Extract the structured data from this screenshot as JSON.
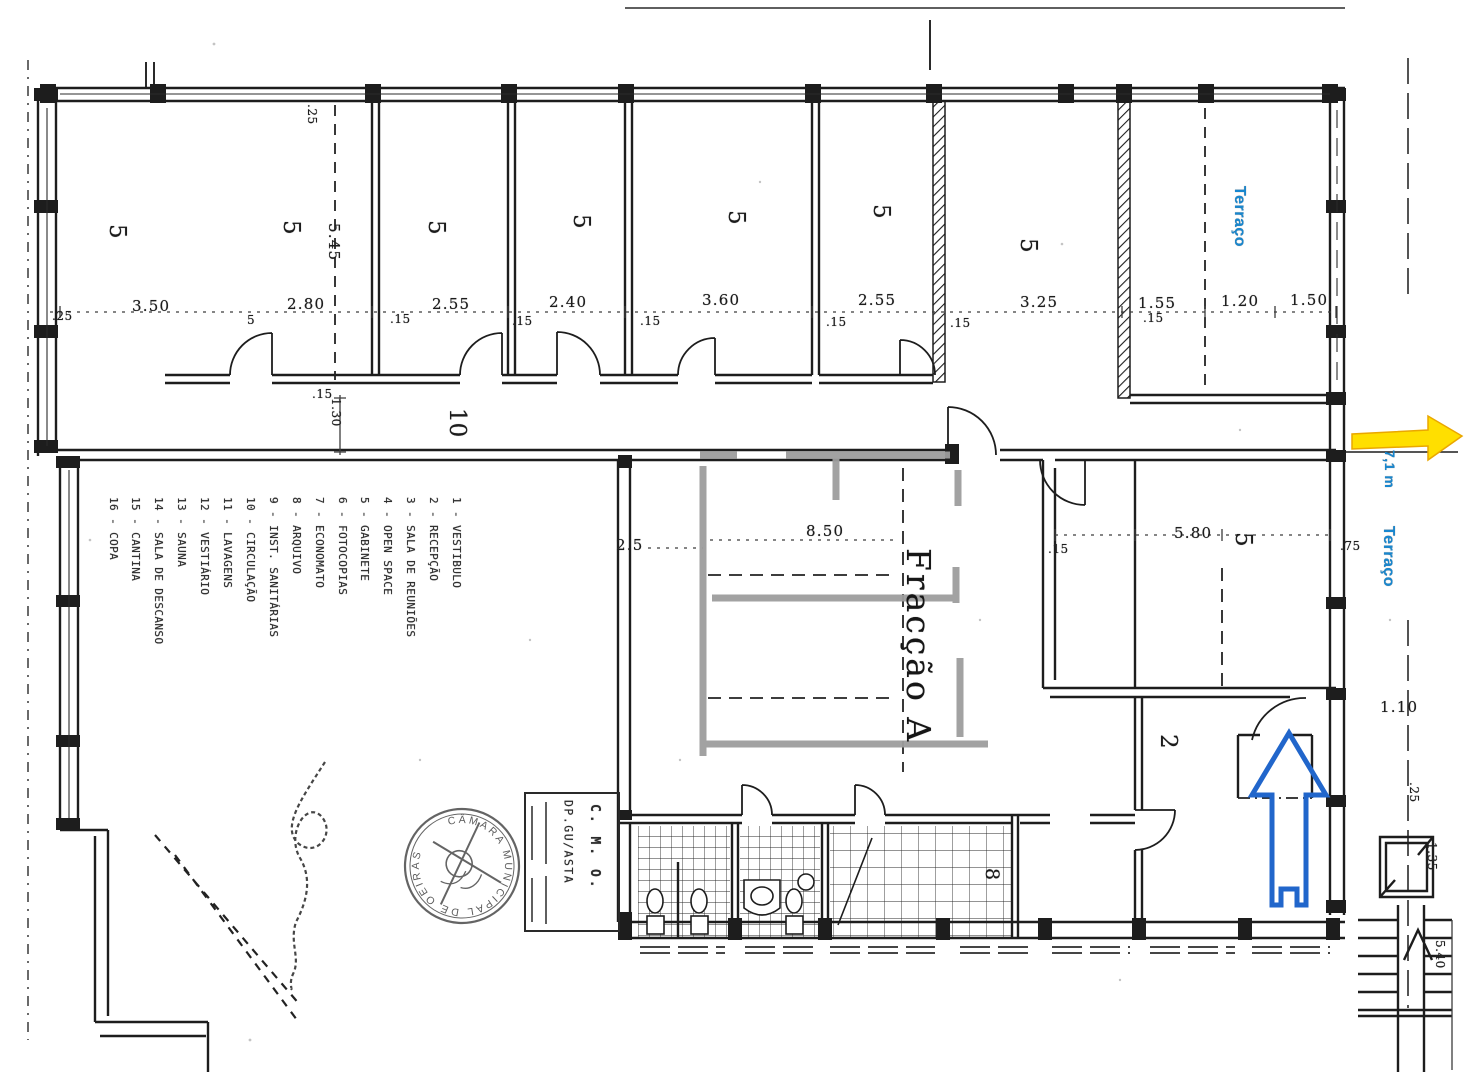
{
  "colors": {
    "ink": "#1d1d1d",
    "annotation_blue": "#1887cf",
    "arrow_blue": "#2166cb",
    "arrow_yellow": "#ffdf00",
    "arrow_yellow_stroke": "#eaa700",
    "highlight_gray": "#9d9d9d"
  },
  "fraccao": {
    "label": "Fracção A"
  },
  "stamp": {
    "ring_text": "CÂMARA MUNICIPAL DE OEIRAS"
  },
  "office_box": {
    "line1": "C. M. O.",
    "line2": "DP.GU/ASTA"
  },
  "legend": {
    "x_start": 451,
    "y": 497,
    "spacing": 22.9,
    "items": [
      {
        "num": "1",
        "name": "VESTIBULO"
      },
      {
        "num": "2",
        "name": "RECEPÇÃO"
      },
      {
        "num": "3",
        "name": "SALA DE REUNIÕES"
      },
      {
        "num": "4",
        "name": "OPEN SPACE"
      },
      {
        "num": "5",
        "name": "GABINETE"
      },
      {
        "num": "6",
        "name": "FOTOCOPIAS"
      },
      {
        "num": "7",
        "name": "ECONOMATO"
      },
      {
        "num": "8",
        "name": "ARQUIVO"
      },
      {
        "num": "9",
        "name": "INST. SANITÁRIAS"
      },
      {
        "num": "10",
        "name": "CIRCULAÇÃO"
      },
      {
        "num": "11",
        "name": "LAVAGENS"
      },
      {
        "num": "12",
        "name": "VESTIÁRIO"
      },
      {
        "num": "13",
        "name": "SAUNA"
      },
      {
        "num": "14",
        "name": "SALA DE DESCANSO"
      },
      {
        "num": "15",
        "name": "CANTINA"
      },
      {
        "num": "16",
        "name": "COPA"
      }
    ]
  },
  "labels": [
    {
      "n": "room-label",
      "t": "5",
      "x": 105,
      "y": 224,
      "c": "room rot"
    },
    {
      "n": "room-label",
      "t": "5",
      "x": 279,
      "y": 220,
      "c": "room rot"
    },
    {
      "n": "room-label",
      "t": "5",
      "x": 424,
      "y": 220,
      "c": "room rot"
    },
    {
      "n": "room-label",
      "t": "5",
      "x": 569,
      "y": 214,
      "c": "room rot"
    },
    {
      "n": "room-label",
      "t": "5",
      "x": 724,
      "y": 210,
      "c": "room rot"
    },
    {
      "n": "room-label",
      "t": "5",
      "x": 869,
      "y": 204,
      "c": "room rot"
    },
    {
      "n": "room-label",
      "t": "5",
      "x": 1016,
      "y": 238,
      "c": "room rot"
    },
    {
      "n": "room-label",
      "t": "5",
      "x": 1231,
      "y": 532,
      "c": "room rot"
    },
    {
      "n": "room-label",
      "t": "10",
      "x": 445,
      "y": 408,
      "c": "room rot"
    },
    {
      "n": "room-label",
      "t": "2",
      "x": 1156,
      "y": 734,
      "c": "room rot"
    },
    {
      "n": "room-label",
      "t": "8",
      "x": 982,
      "y": 868,
      "c": "room rot",
      "s": 19
    },
    {
      "n": "dimension-label",
      "t": "3.50",
      "x": 132,
      "y": 299,
      "c": "dim"
    },
    {
      "n": "dimension-label",
      "t": "2.80",
      "x": 287,
      "y": 297,
      "c": "dim"
    },
    {
      "n": "dimension-label",
      "t": "2.55",
      "x": 432,
      "y": 297,
      "c": "dim"
    },
    {
      "n": "dimension-label",
      "t": "2.40",
      "x": 549,
      "y": 295,
      "c": "dim"
    },
    {
      "n": "dimension-label",
      "t": "3.60",
      "x": 702,
      "y": 293,
      "c": "dim"
    },
    {
      "n": "dimension-label",
      "t": "2.55",
      "x": 858,
      "y": 293,
      "c": "dim"
    },
    {
      "n": "dimension-label",
      "t": "3.25",
      "x": 1020,
      "y": 295,
      "c": "dim"
    },
    {
      "n": "dimension-label",
      "t": "1.55",
      "x": 1138,
      "y": 296,
      "c": "dim"
    },
    {
      "n": "dimension-label",
      "t": "1.20",
      "x": 1221,
      "y": 294,
      "c": "dim"
    },
    {
      "n": "dimension-label",
      "t": "1.50",
      "x": 1290,
      "y": 293,
      "c": "dim"
    },
    {
      "n": "dimension-label",
      "t": ".25",
      "x": 52,
      "y": 310,
      "c": "dim sm"
    },
    {
      "n": "dimension-label",
      "t": "5",
      "x": 247,
      "y": 314,
      "c": "dim sm"
    },
    {
      "n": "dimension-label",
      "t": ".15",
      "x": 390,
      "y": 313,
      "c": "dim sm"
    },
    {
      "n": "dimension-label",
      "t": ".15",
      "x": 512,
      "y": 315,
      "c": "dim sm"
    },
    {
      "n": "dimension-label",
      "t": ".15",
      "x": 640,
      "y": 315,
      "c": "dim sm"
    },
    {
      "n": "dimension-label",
      "t": ".15",
      "x": 826,
      "y": 316,
      "c": "dim sm"
    },
    {
      "n": "dimension-label",
      "t": ".15",
      "x": 950,
      "y": 317,
      "c": "dim sm"
    },
    {
      "n": "dimension-label",
      "t": ".15",
      "x": 1143,
      "y": 312,
      "c": "dim sm"
    },
    {
      "n": "dimension-label",
      "t": ".25",
      "x": 306,
      "y": 104,
      "c": "dim sm rot"
    },
    {
      "n": "dimension-label",
      "t": "5.45",
      "x": 326,
      "y": 223,
      "c": "dim rot"
    },
    {
      "n": "dimension-label",
      "t": "1.30",
      "x": 330,
      "y": 398,
      "c": "dim sm rot"
    },
    {
      "n": "dimension-label",
      "t": ".15",
      "x": 312,
      "y": 388,
      "c": "dim sm"
    },
    {
      "n": "dimension-label",
      "t": "2.5",
      "x": 616,
      "y": 538,
      "c": "dim"
    },
    {
      "n": "dimension-label",
      "t": "8.50",
      "x": 806,
      "y": 524,
      "c": "dim"
    },
    {
      "n": "dimension-label",
      "t": "5.80",
      "x": 1174,
      "y": 526,
      "c": "dim"
    },
    {
      "n": "dimension-label",
      "t": ".15",
      "x": 1048,
      "y": 543,
      "c": "dim sm"
    },
    {
      "n": "dimension-label",
      "t": ".75",
      "x": 1340,
      "y": 540,
      "c": "dim sm"
    },
    {
      "n": "dimension-label",
      "t": "1.10",
      "x": 1380,
      "y": 700,
      "c": "dim"
    },
    {
      "n": "dimension-label",
      "t": ".25",
      "x": 1408,
      "y": 782,
      "c": "dim sm rot"
    },
    {
      "n": "dimension-label",
      "t": "1.35",
      "x": 1426,
      "y": 842,
      "c": "dim sm rot"
    },
    {
      "n": "dimension-label",
      "t": "5.40",
      "x": 1434,
      "y": 940,
      "c": "dim sm rot"
    },
    {
      "n": "annotation-terraco-top",
      "t": "Terraço",
      "x": 1231,
      "y": 186,
      "c": "annot rot",
      "col": "annotation_blue"
    },
    {
      "n": "annotation-terraco-right",
      "t": "Terraço",
      "x": 1380,
      "y": 526,
      "c": "annot rot",
      "col": "annotation_blue"
    },
    {
      "n": "annotation-width",
      "t": "7,1 m",
      "x": 1383,
      "y": 450,
      "c": "annot rot",
      "s": 14,
      "col": "annotation_blue"
    }
  ]
}
